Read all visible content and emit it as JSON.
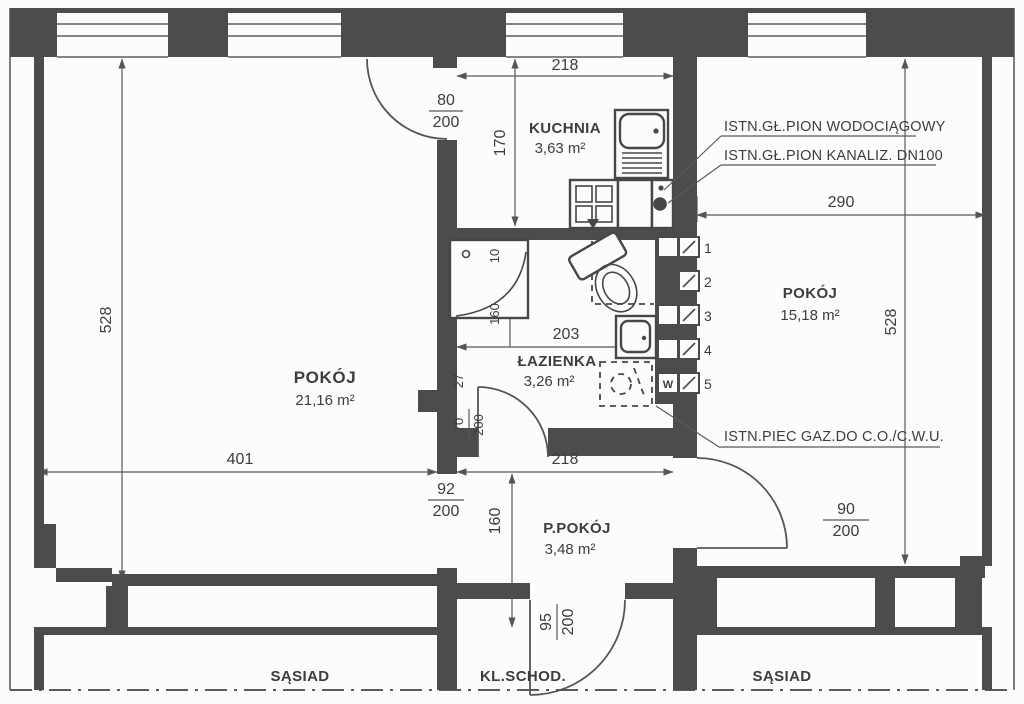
{
  "rooms": {
    "room_left": {
      "name": "POKÓJ",
      "area": "21,16 m²"
    },
    "kitchen": {
      "name": "KUCHNIA",
      "area": "3,63 m²"
    },
    "bathroom": {
      "name": "ŁAZIENKA",
      "area": "3,26 m²"
    },
    "room_right": {
      "name": "POKÓJ",
      "area": "15,18 m²"
    },
    "hall": {
      "name": "P.POKÓJ",
      "area": "3,48 m²"
    },
    "neighbor_left": {
      "name": "SĄSIAD"
    },
    "staircase": {
      "name": "KL.SCHOD."
    },
    "neighbor_right": {
      "name": "SĄSIAD"
    }
  },
  "dimensions": {
    "kitchen_width": "218",
    "kitchen_depth": "170",
    "left_room_height": "528",
    "right_room_height": "528",
    "right_room_width": "290",
    "bath_width": "203",
    "left_room_width": "401",
    "hall_width": "218",
    "hall_depth": "160",
    "shower_gap": "10",
    "shower_side": "160",
    "duct": "27",
    "doors": {
      "kitchen": {
        "num": "80",
        "den": "200"
      },
      "room_left": {
        "num": "92",
        "den": "200"
      },
      "room_right": {
        "num": "90",
        "den": "200"
      },
      "bath": {
        "num": "70",
        "den": "200"
      },
      "entrance": {
        "num": "95",
        "den": "200"
      }
    }
  },
  "annotations": {
    "water": "ISTN.GŁ.PION WODOCIĄGOWY",
    "sewage": "ISTN.GŁ.PION KANALIZ. DN100",
    "furnace": "ISTN.PIEC GAZ.DO C.O./C.W.U."
  },
  "markers": {
    "m1": "1",
    "m2": "2",
    "m3": "3",
    "m4": "4",
    "m5": "5",
    "w": "W"
  },
  "colors": {
    "line": "#4c4c4c",
    "background": "#fcfcfa"
  }
}
